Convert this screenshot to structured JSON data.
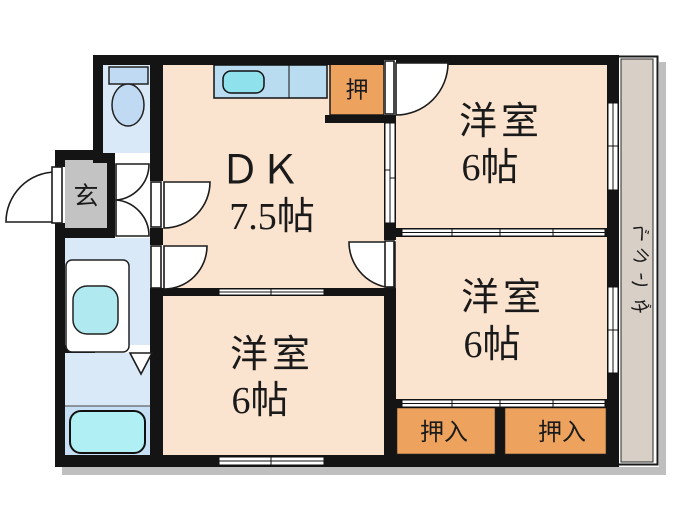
{
  "floor_plan": {
    "labels": {
      "dk_name": "ＤＫ",
      "dk_size": "7.5帖",
      "room_top_right_name": "洋室",
      "room_top_right_size": "6帖",
      "room_middle_right_name": "洋室",
      "room_middle_right_size": "6帖",
      "room_bottom_name": "洋室",
      "room_bottom_size": "6帖",
      "closet_top": "押",
      "closet_bottom_left": "押入",
      "closet_bottom_right": "押入",
      "entrance": "玄",
      "balcony": "ベランダ",
      "balcony_chars": [
        "ベ",
        "ラ",
        "ン",
        "ダ"
      ]
    },
    "colors": {
      "room_floor": "#fbe4cf",
      "closet_orange": "#eda25e",
      "wet_floor": "#d9e9f8",
      "bath_lower": "#c7dff4",
      "counter_blue": "#b9dcf0",
      "sink_cyan": "#8fe1ec",
      "toilet_blue": "#c0daf3",
      "basin_cyan": "#b0e9f0",
      "tub_cyan": "#b0eff3",
      "entrance_gray": "#c3c3c3",
      "balcony_beige": "#d8cfc6",
      "wall_black": "#141414"
    }
  }
}
